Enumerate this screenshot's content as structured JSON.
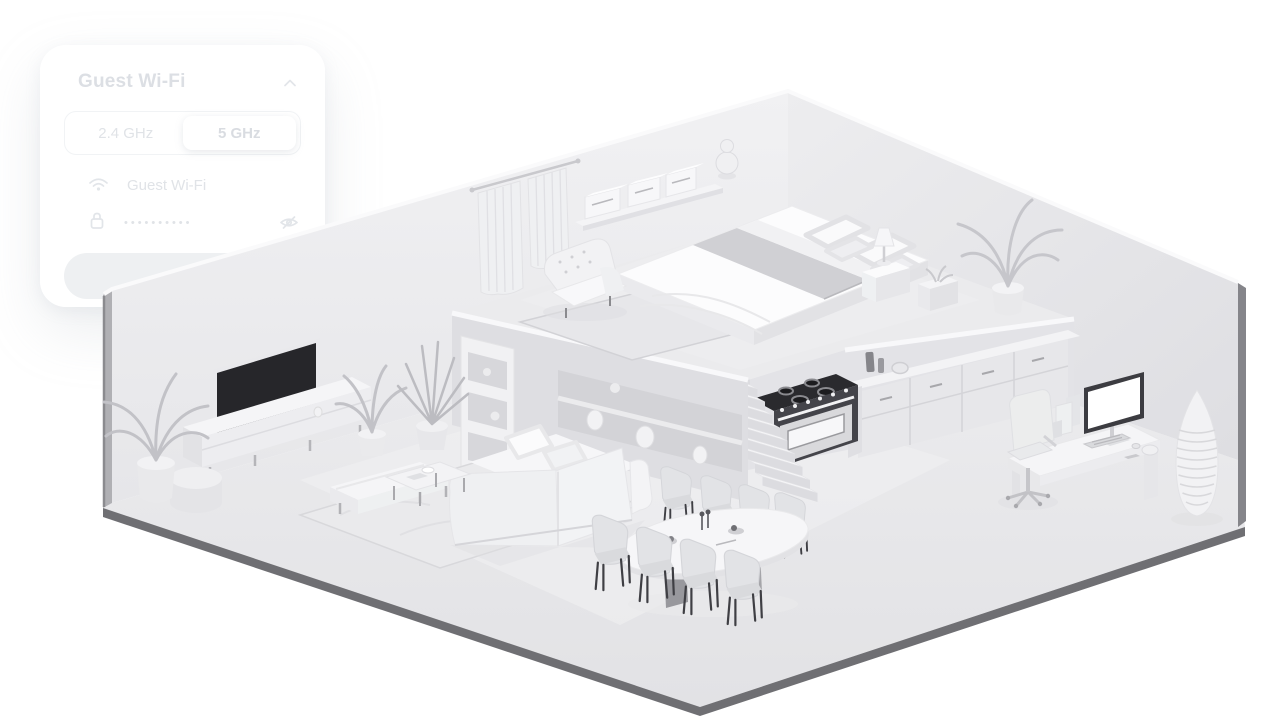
{
  "panel": {
    "title": "Guest Wi-Fi",
    "collapse_icon": "chevron-up",
    "band_selector": {
      "options": [
        "2.4 GHz",
        "5 GHz"
      ],
      "selected": "5 GHz"
    },
    "ssid_field": {
      "icon": "wifi",
      "value": "Guest Wi-Fi"
    },
    "password_field": {
      "icon": "lock",
      "masked_value": "••••••••••",
      "visibility_toggle_icon": "eye-off"
    },
    "save_button": {
      "label": "Save"
    }
  },
  "scene": {
    "type": "isometric-apartment-cutaway",
    "style": "monochrome 3D render",
    "areas": [
      "bedroom loft",
      "living room",
      "kitchen",
      "dining area",
      "home office"
    ],
    "colors": {
      "background": "#ffffff",
      "walls": "#ebebee",
      "floor": "#e8e8ea",
      "floor_edge": "#6f6f73",
      "tv_screen": "#26262a",
      "stove_cooktop": "#2a2a2e"
    }
  }
}
